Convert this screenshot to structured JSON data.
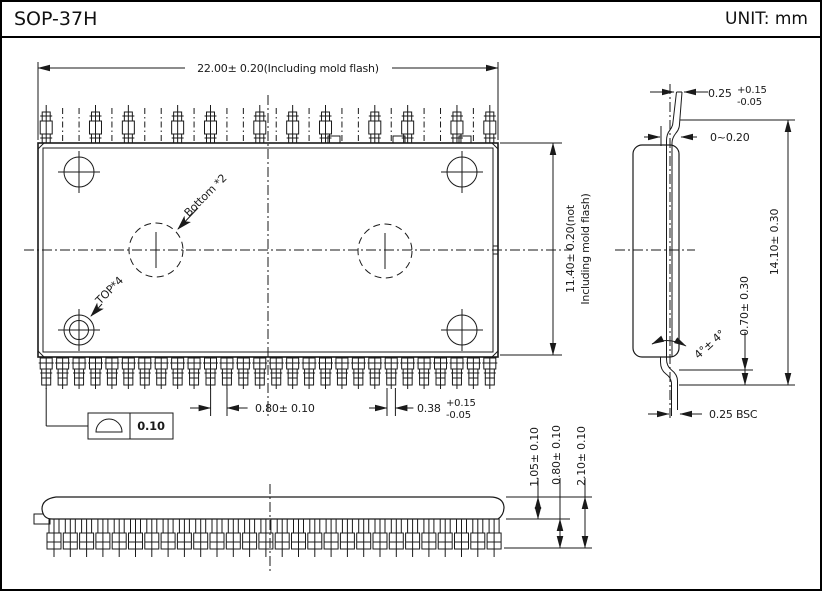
{
  "header": {
    "title": "SOP-37H",
    "unit": "UNIT: mm"
  },
  "top_view": {
    "dim_width": "22.00± 0.20(Including mold flash)",
    "dim_height_l1": "11.40± 0.20(not",
    "dim_height_l2": "Including mold flash)",
    "dim_pitch": "0.80± 0.10",
    "dim_lead_width": "0.38",
    "dim_lead_width_plus": "+0.15",
    "dim_lead_width_minus": "-0.05",
    "coplanarity_value": "0.10",
    "callout_bottom": "Bottom *2",
    "callout_top": "TOP*4"
  },
  "side_view": {
    "dim_lead_tip": "0.25",
    "dim_lead_tip_plus": "+0.15",
    "dim_lead_tip_minus": "-0.05",
    "dim_standoff": "0~0.20",
    "dim_overall": "14.10± 0.30",
    "dim_foot": "0.70± 0.30",
    "dim_angle": "4°± 4°",
    "dim_tip_bsc": "0.25 BSC"
  },
  "front_view": {
    "dim_body": "1.05± 0.10",
    "dim_lead": "0.80± 0.10",
    "dim_total": "2.10± 0.10"
  }
}
